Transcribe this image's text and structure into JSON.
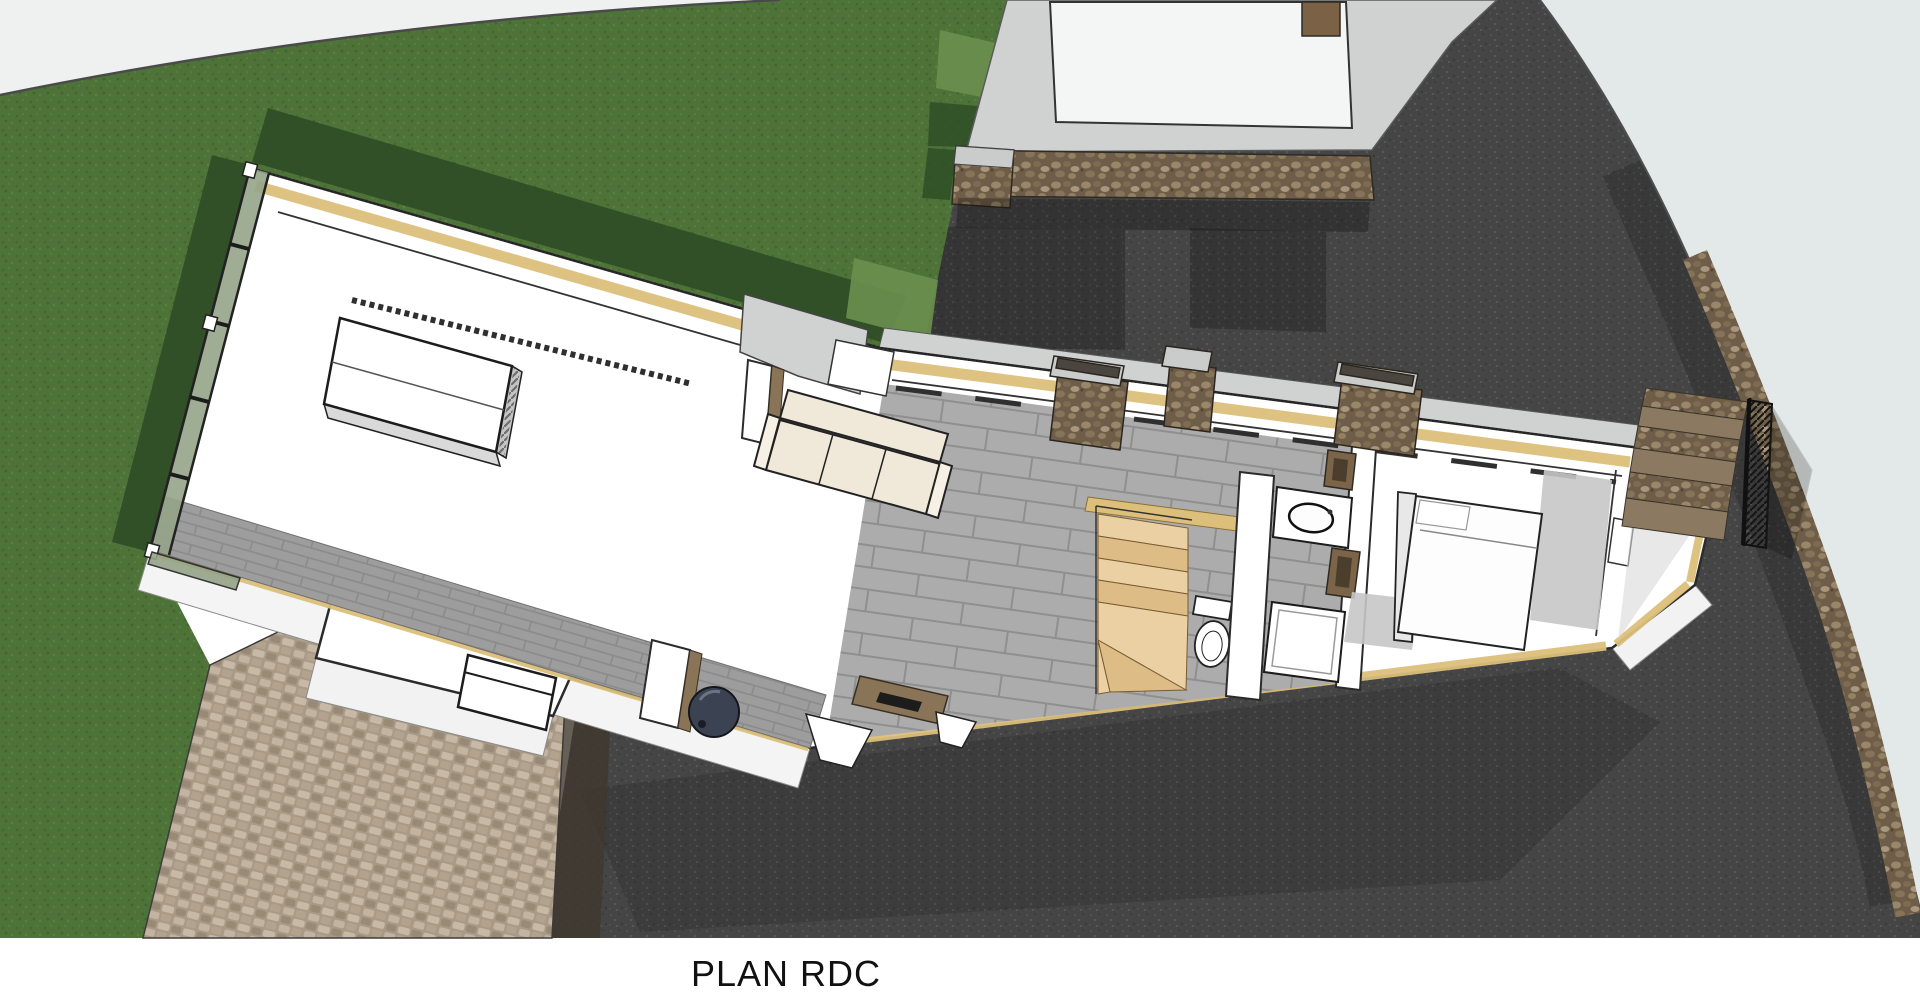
{
  "caption": {
    "label": "PLAN RDC"
  },
  "palette": {
    "page_bg": "#ffffff",
    "caption_color": "#111111",
    "lawn": "#4e7338",
    "lawn_shadow": "#2f4d27",
    "lawn_light": "#6b8f4e",
    "asphalt": "#454545",
    "asphalt_shadow": "#2d2d2d",
    "road": "#e3e9e8",
    "path_pale": "#eef1f0",
    "cobble_base": "#a99a87",
    "stone_wall": "#6e5d48",
    "insulation": "#dcbf7a",
    "concrete": "#cfd2d1",
    "wall_white": "#ffffff",
    "outline": "#2b2b2b",
    "tile_gray": "#acacac",
    "block_gray": "#9d9d9d",
    "wood_step": "#ead0a2",
    "wood_step_alt": "#ddbd85",
    "wood_brown": "#8a7458",
    "sofa_cream": "#f0e9da",
    "glass_green": "#95a488",
    "stove_dark": "#3b4252",
    "bed_white": "#fdfdfd"
  },
  "scene": {
    "type": "3d-floor-plan-render",
    "floor": "ground-floor",
    "elements": [
      "lawn",
      "pale-footpath",
      "driveway-asphalt",
      "road-edge",
      "garage-slab",
      "stone-garden-wall",
      "cobblestone-path",
      "house-footprint",
      "insulation-band",
      "window-wall-glazing",
      "kitchen-island",
      "sofa",
      "wood-stove",
      "hearth-table",
      "bench",
      "interior-winder-stairs",
      "toilet",
      "vanity-sink",
      "shower",
      "partition-walls",
      "bed",
      "stone-piers",
      "entry-porch",
      "east-terrace",
      "exterior-stone-stairs",
      "stair-railing"
    ]
  }
}
